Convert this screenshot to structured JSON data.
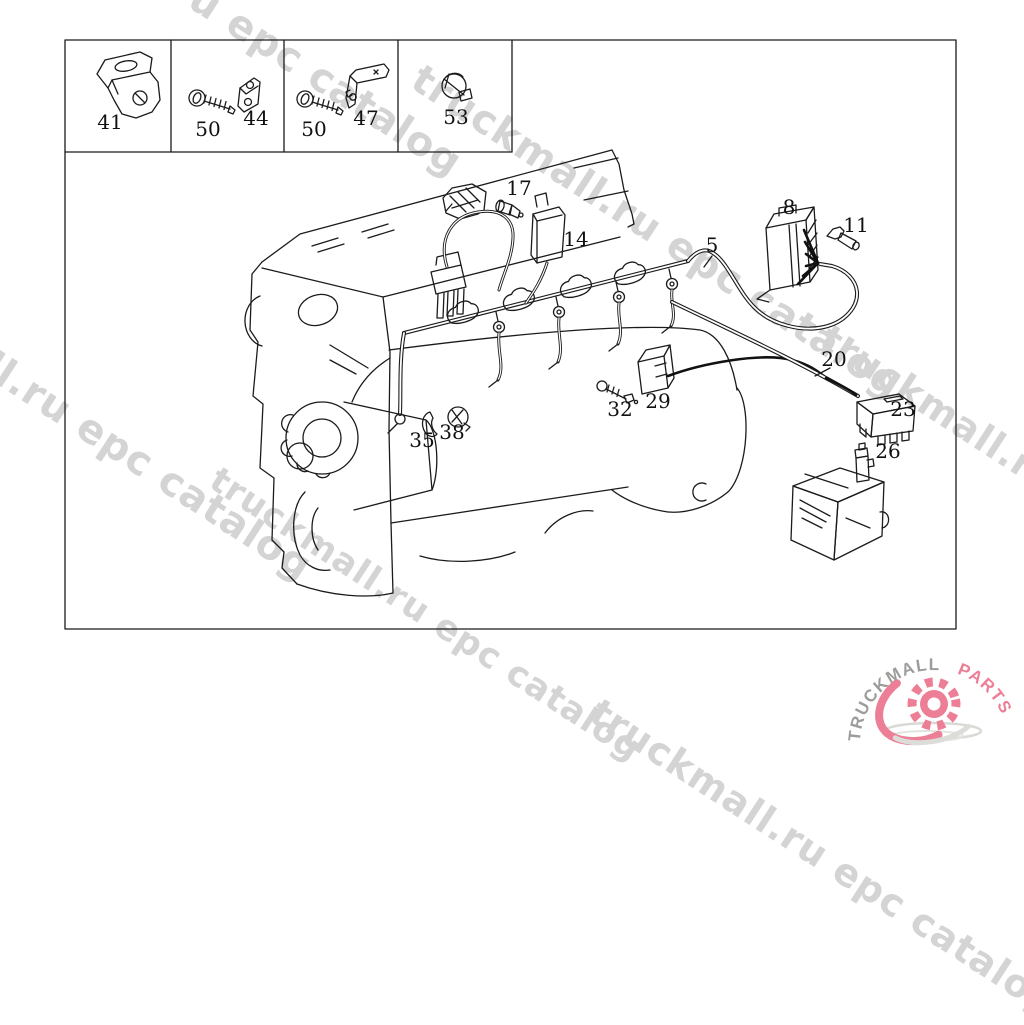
{
  "watermark": {
    "text": "truckmall.ru epc catalog",
    "color": "#d4d4d4"
  },
  "legend": {
    "cells": [
      {
        "parts": [
          {
            "label": "41",
            "name": "angle-bracket"
          }
        ]
      },
      {
        "parts": [
          {
            "label": "50",
            "name": "bolt"
          },
          {
            "label": "44",
            "name": "clamp-plate"
          }
        ]
      },
      {
        "parts": [
          {
            "label": "50",
            "name": "bolt"
          },
          {
            "label": "47",
            "name": "l-bracket"
          }
        ]
      },
      {
        "parts": [
          {
            "label": "53",
            "name": "cable-clip"
          }
        ]
      }
    ]
  },
  "diagram": {
    "callouts": [
      {
        "label": "17",
        "part": "sensor-screw"
      },
      {
        "label": "14",
        "part": "suppressor-module"
      },
      {
        "label": "5",
        "part": "wiring-harness"
      },
      {
        "label": "8",
        "part": "plug-connector"
      },
      {
        "label": "11",
        "part": "terminal-pin"
      },
      {
        "label": "20",
        "part": "cable"
      },
      {
        "label": "23",
        "part": "relay-connector"
      },
      {
        "label": "26",
        "part": "bulb-socket"
      },
      {
        "label": "29",
        "part": "coupler"
      },
      {
        "label": "32",
        "part": "screw"
      },
      {
        "label": "35",
        "part": "clip"
      },
      {
        "label": "38",
        "part": "grommet"
      }
    ]
  },
  "logo": {
    "brand_primary": "TRUCKMALL",
    "brand_secondary": "PARTS",
    "colors": {
      "primary": "#9c9c9a",
      "secondary": "#ec7e96",
      "gear": "#ec7e96",
      "shadow": "#d9d9d5"
    }
  }
}
